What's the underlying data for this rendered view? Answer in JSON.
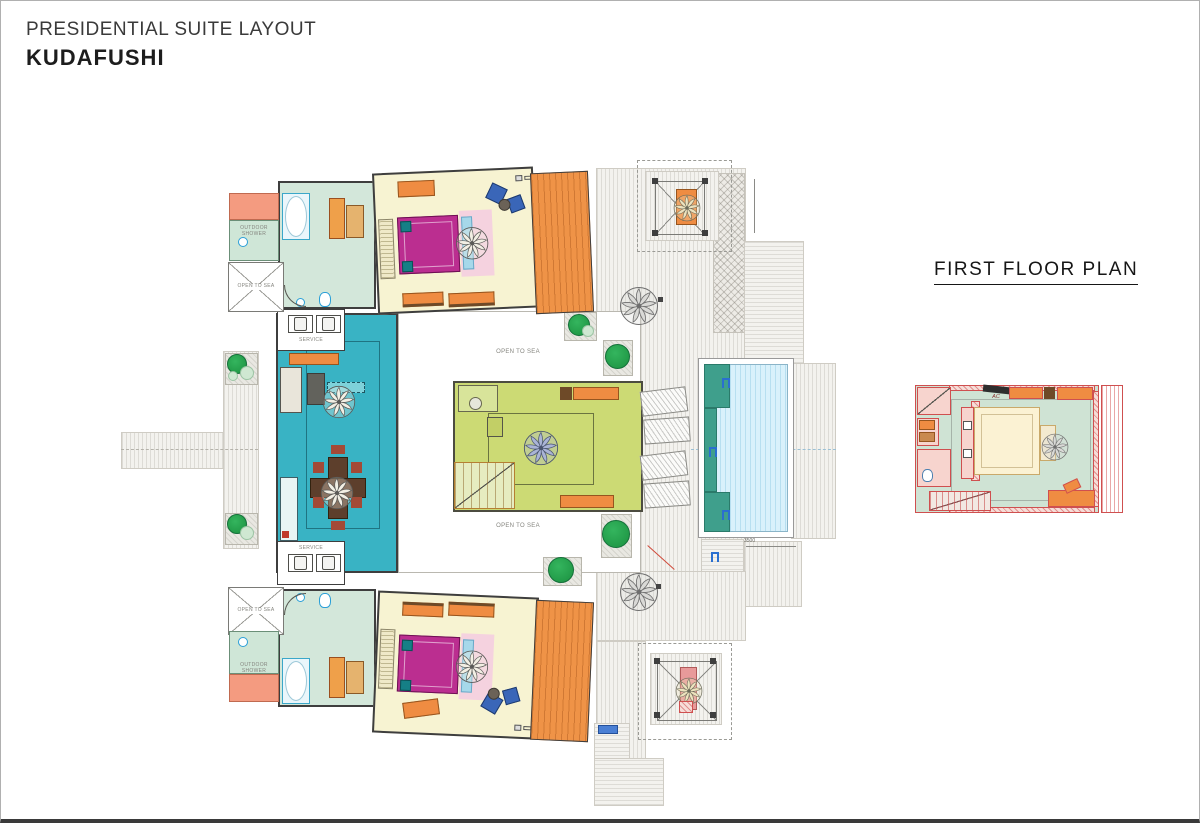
{
  "header": {
    "title": "PRESIDENTIAL SUITE LAYOUT",
    "brand": "KUDAFUSHI"
  },
  "side_plan": {
    "title": "FIRST FLOOR PLAN",
    "ac_label": "AC"
  },
  "labels": {
    "open_to_sea": "OPEN TO SEA",
    "outdoor_shower": "OUTDOOR SHOWER",
    "service": "SERVICE",
    "pool_dim": "3500"
  },
  "colors": {
    "living_teal": "#39b3c4",
    "lounge_green": "#ccda74",
    "bedroom_cream": "#f7f3d2",
    "bed_magenta": "#bb2e90",
    "furniture_orange": "#ef8c42",
    "pool_water": "#d9f1fb",
    "pool_ledge": "#3f9f8c",
    "bathroom_mint": "#d3e7da",
    "deck_salmon": "#f49b80",
    "plan_red": "#cf4f4f",
    "tree_green": "#22a14b"
  }
}
